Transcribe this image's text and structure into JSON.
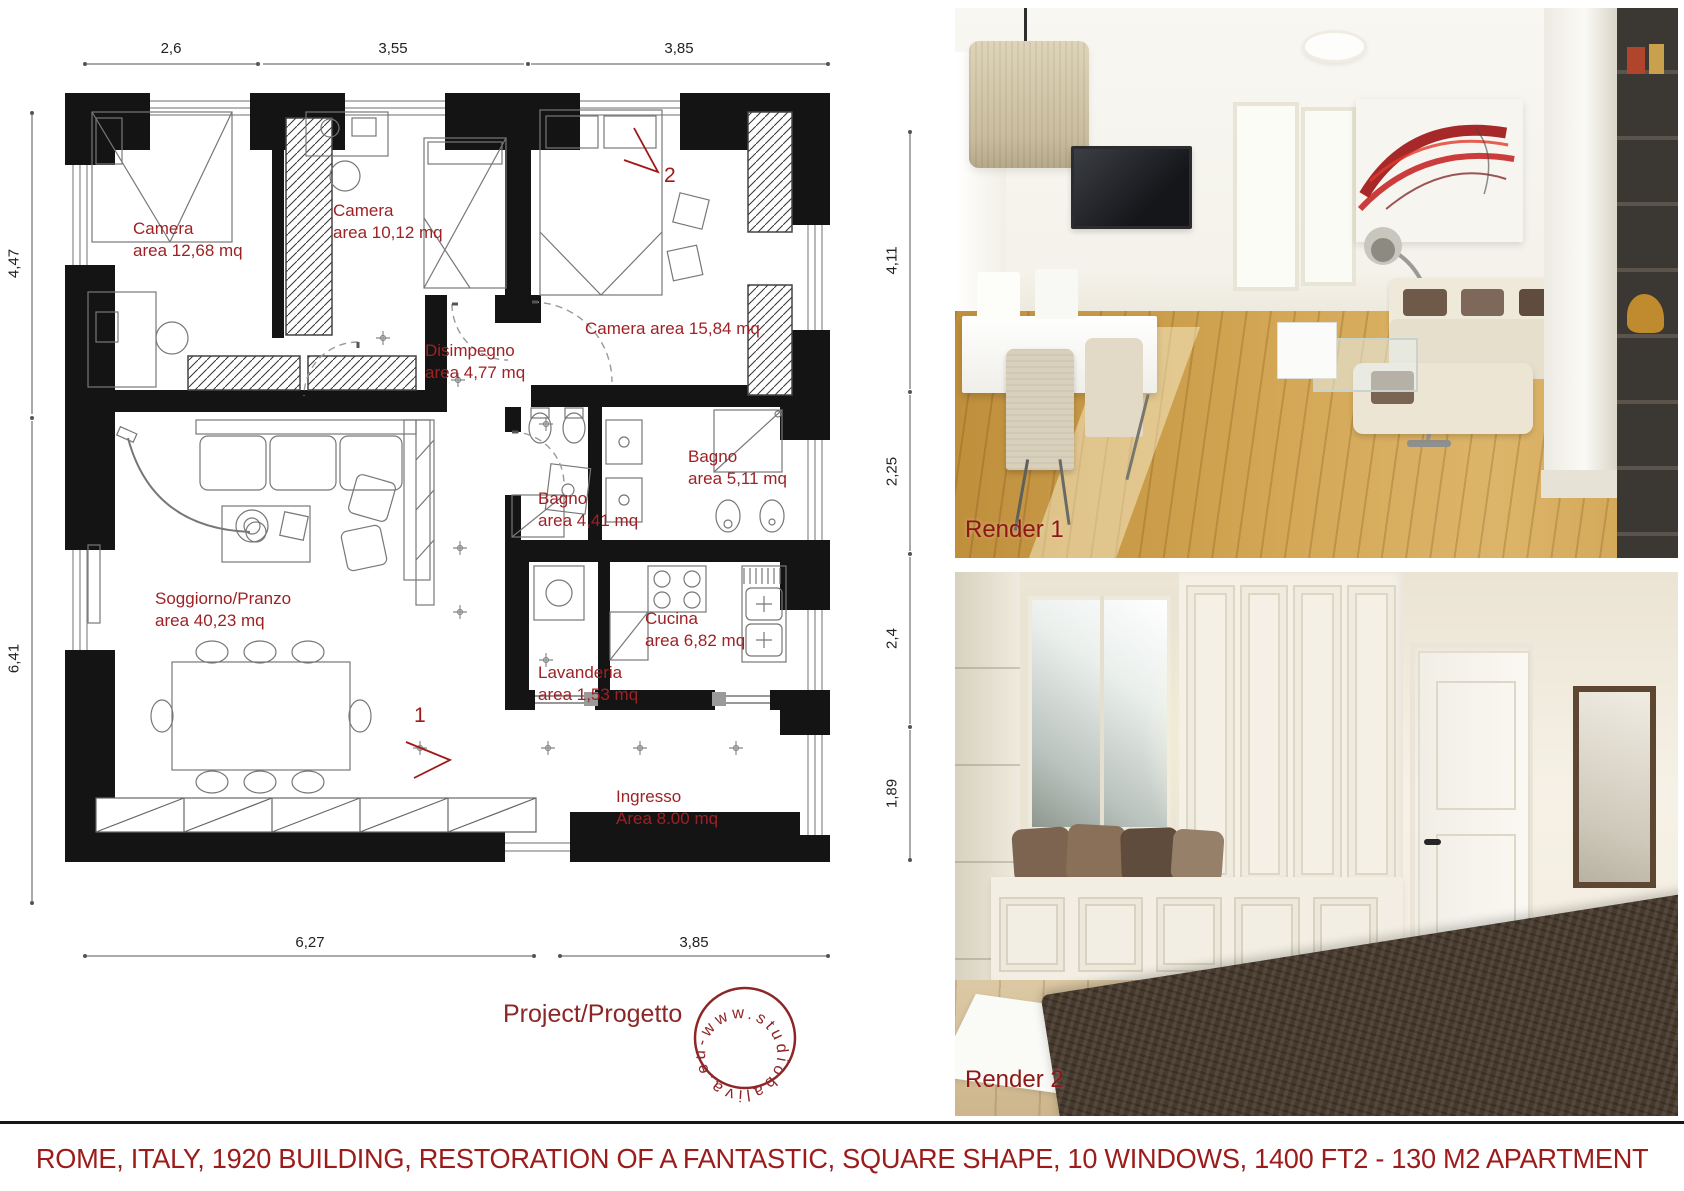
{
  "colors": {
    "accent_red": "#9e2124",
    "caption_red": "#9c1b1b",
    "stamp_red": "#8d2626",
    "wall_black": "#141414"
  },
  "plan": {
    "dims_top": [
      "2,6",
      "3,55",
      "3,85"
    ],
    "dims_bottom": [
      "6,27",
      "3,85"
    ],
    "dims_left": [
      "4,47",
      "6,41"
    ],
    "dims_right": [
      "4,11",
      "2,25",
      "2,4",
      "1,89"
    ],
    "rooms": [
      {
        "name": "Camera",
        "area": "area 12,68 mq"
      },
      {
        "name": "Camera",
        "area": "area 10,12 mq"
      },
      {
        "name": "Camera area 15,84 mq",
        "area": ""
      },
      {
        "name": "Disimpegno",
        "area": "area 4,77 mq"
      },
      {
        "name": "Bagno",
        "area": "area 5,11 mq"
      },
      {
        "name": "Bagno",
        "area": "area 4,41 mq"
      },
      {
        "name": "Soggiorno/Pranzo",
        "area": "area 40,23 mq"
      },
      {
        "name": "Cucina",
        "area": "area 6,82 mq"
      },
      {
        "name": "Lavanderia",
        "area": "area 1,53 mq"
      },
      {
        "name": "Ingresso",
        "area": "Area 8.00 mq"
      }
    ],
    "markers": [
      "1",
      "2"
    ],
    "project_label": "Project/Progetto",
    "stamp_text": "www.studiobaliva.eu-"
  },
  "renders": [
    {
      "label": "Render 1"
    },
    {
      "label": "Render 2"
    }
  ],
  "caption": "ROME, ITALY, 1920 BUILDING, RESTORATION OF A FANTASTIC, SQUARE SHAPE, 10 WINDOWS, 1400 FT2 - 130 M2 APARTMENT"
}
